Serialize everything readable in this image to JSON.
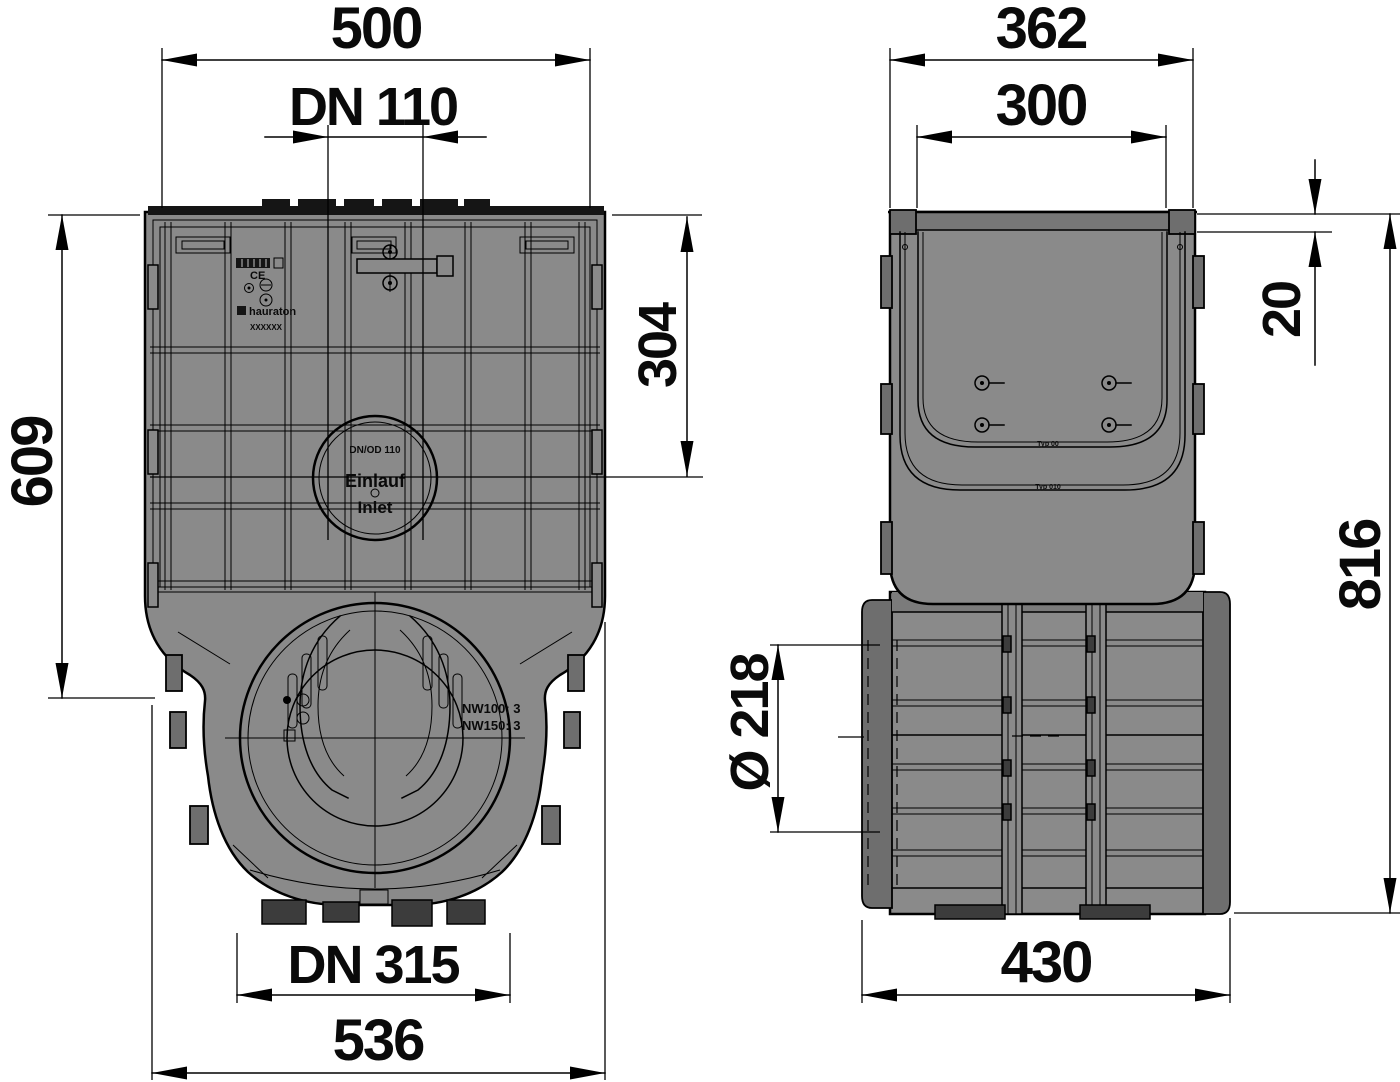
{
  "front_view": {
    "dim_overall_width_top": "500",
    "dim_inlet": "DN 110",
    "dim_height": "609",
    "dim_inlet_center_offset": "304",
    "dim_outlet": "DN 315",
    "dim_overall_width_bottom": "536",
    "inlet_marking": {
      "size": "DN/OD 110",
      "line_de": "Einlauf",
      "line_en": "Inlet"
    },
    "label_plate": {
      "ce_mark": "CE",
      "brand": "hauraton",
      "serial": "XXXXXX"
    },
    "outlet_marking": {
      "line1": "NW100: 3",
      "line2": "NW150: 3"
    }
  },
  "side_view": {
    "dim_overall_width_top": "362",
    "dim_inner_width": "300",
    "dim_edge_height": "20",
    "dim_total_height": "816",
    "dim_outlet_diameter": "Ø 218",
    "dim_base_width": "430",
    "markings": {
      "typ_upper": "Typ 00",
      "typ_lower": "Typ 010"
    }
  },
  "colors": {
    "background": "#ffffff",
    "body_gray": "#8a8a8a",
    "dark_gray": "#6e6e6e",
    "line_black": "#000000"
  }
}
